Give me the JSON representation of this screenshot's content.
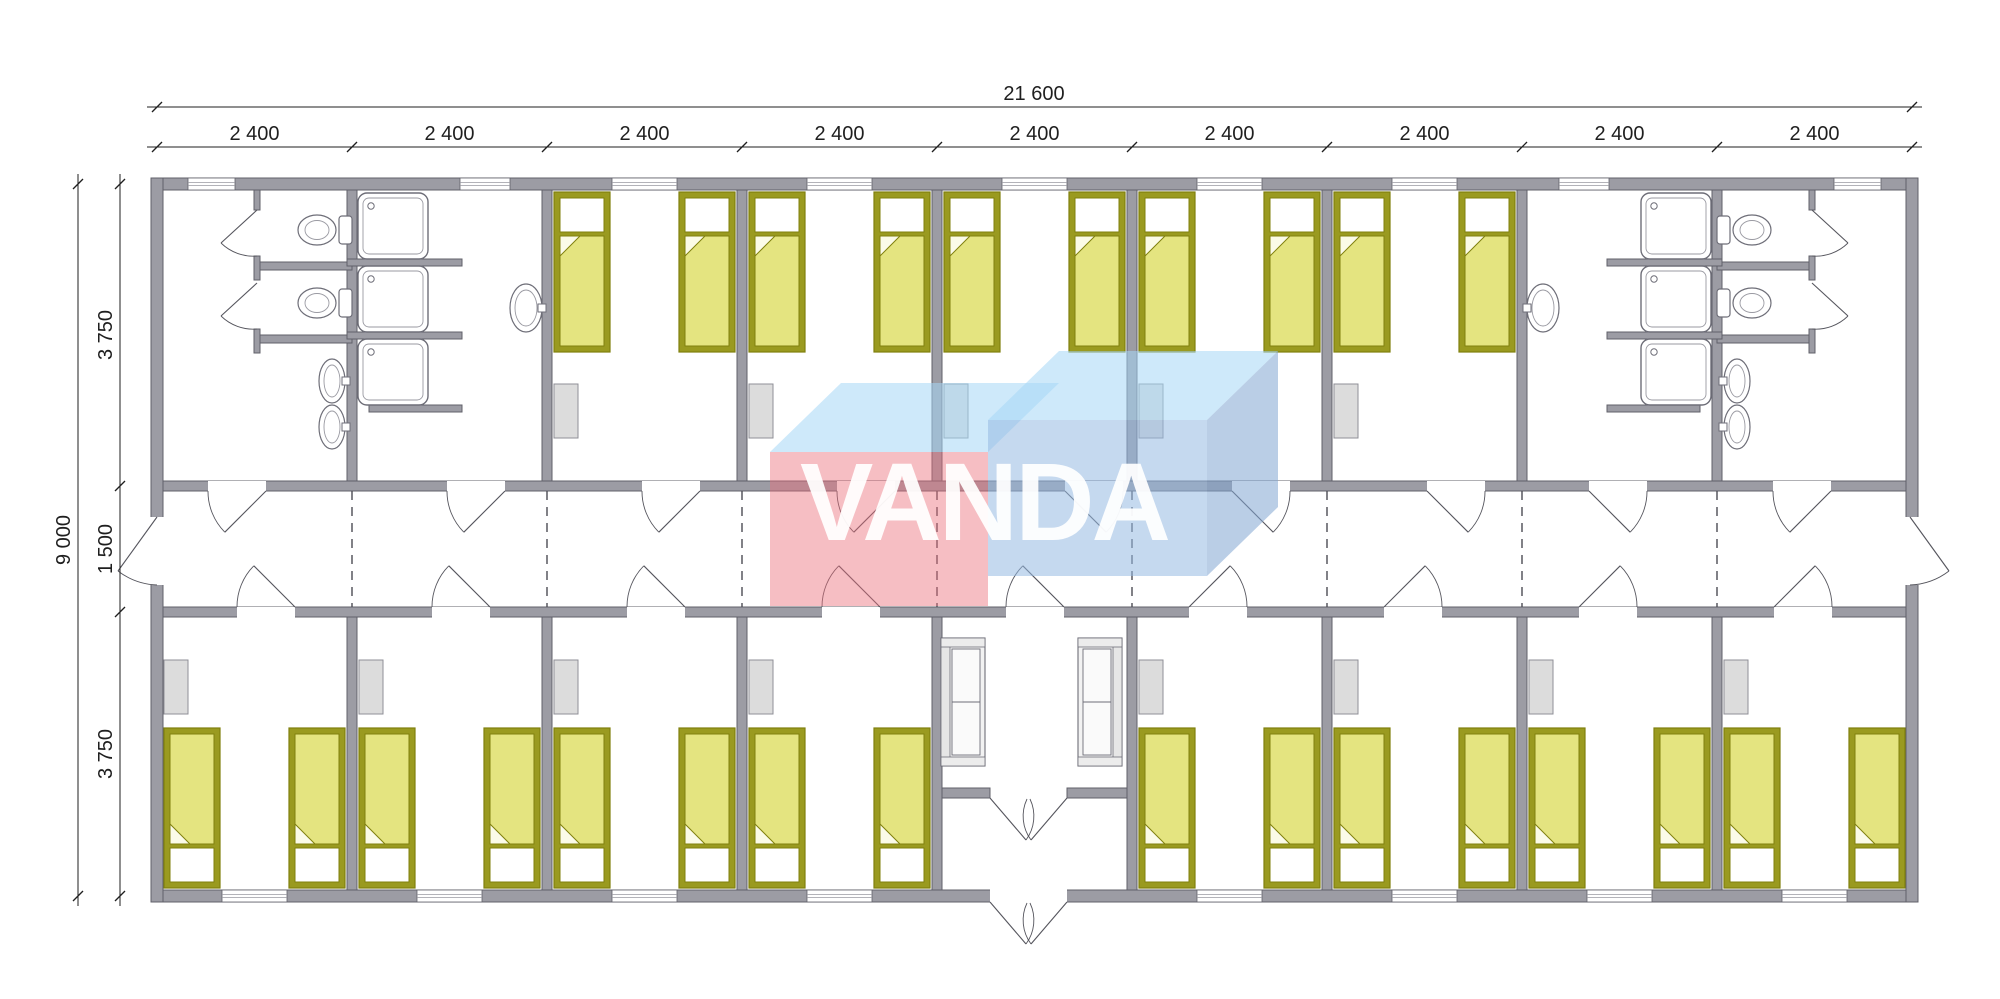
{
  "watermark": {
    "text": "VANDA"
  },
  "dimensions": {
    "overall_width": "21 600",
    "module_width": "2 400",
    "module_count": 9,
    "overall_depth": "9 000",
    "depth_segments": [
      "3 750",
      "1 500",
      "3 750"
    ]
  },
  "inventory": {
    "bedrooms": 13,
    "single_beds": 26,
    "wardrobes": 13,
    "shower_cabins": 6,
    "toilets": 4,
    "wash_basins": 6,
    "sofas": 2,
    "wc_rooms": 2,
    "shower_rooms": 2,
    "entrance_lobby": 1,
    "corridor": 1
  },
  "colors": {
    "wall_fill": "#9c9ca4",
    "wall_stroke": "#60606a",
    "bed_frame": "#9a9a20",
    "bed_blanket": "#e4e480",
    "bed_outline": "#80800e",
    "fold_fill": "#fbfbe8",
    "pillow": "#ffffff",
    "furniture_fill": "#dcdcdc",
    "furniture_stroke": "#8f8f97",
    "fixture_stroke": "#6e6e78",
    "fixture_fill": "#ffffff",
    "door_line": "#55555d",
    "dash_line": "#4c4c54",
    "dim_color": "#1f1f1f",
    "wm_red": "rgba(236,110,122,0.45)",
    "wm_red_top": "rgba(165,215,245,0.55)",
    "wm_blue": "rgba(150,185,225,0.55)",
    "wm_blue_top": "rgba(165,215,245,0.55)",
    "wm_blue_side": "rgba(130,165,210,0.55)",
    "wm_text": "rgba(255,255,255,0.93)"
  },
  "layout": {
    "canvas": {
      "w": 2000,
      "h": 999
    },
    "wall_x": [
      157,
      352,
      547,
      742,
      937,
      1132,
      1327,
      1522,
      1717,
      1912
    ],
    "y": {
      "top_out": 178,
      "top_in": 190,
      "corr_top_out": 481,
      "corr_top_in": 491,
      "corr_bot_in": 607,
      "corr_bot_out": 617,
      "bot_in": 890,
      "bot_out": 902,
      "left_out": 151,
      "left_in": 163,
      "right_in": 1906,
      "right_out": 1918
    },
    "top_bedrooms": [
      [
        547,
        742
      ],
      [
        742,
        937
      ],
      [
        937,
        1132
      ],
      [
        1132,
        1327
      ],
      [
        1327,
        1522
      ]
    ],
    "bottom_bedrooms": [
      [
        157,
        352
      ],
      [
        352,
        547
      ],
      [
        547,
        742
      ],
      [
        742,
        937
      ],
      [
        1132,
        1327
      ],
      [
        1327,
        1522
      ],
      [
        1522,
        1717
      ],
      [
        1717,
        1912
      ]
    ],
    "windows_top": [
      [
        188,
        235
      ],
      [
        460,
        510
      ],
      [
        612,
        677
      ],
      [
        807,
        872
      ],
      [
        1002,
        1067
      ],
      [
        1197,
        1262
      ],
      [
        1392,
        1457
      ],
      [
        1559,
        1609
      ],
      [
        1834,
        1881
      ]
    ],
    "windows_bottom": [
      [
        222,
        287
      ],
      [
        417,
        482
      ],
      [
        612,
        677
      ],
      [
        807,
        872
      ],
      [
        1197,
        1262
      ],
      [
        1392,
        1457
      ],
      [
        1587,
        1652
      ],
      [
        1782,
        1847
      ]
    ],
    "doors_top": [
      {
        "x1": 208,
        "x2": 266,
        "hinge": "right"
      },
      {
        "x1": 447,
        "x2": 505,
        "hinge": "right"
      },
      {
        "x1": 642,
        "x2": 700,
        "hinge": "right"
      },
      {
        "x1": 837,
        "x2": 895,
        "hinge": "right"
      },
      {
        "x1": 1065,
        "x2": 1123,
        "hinge": "left"
      },
      {
        "x1": 1232,
        "x2": 1290,
        "hinge": "left"
      },
      {
        "x1": 1427,
        "x2": 1485,
        "hinge": "left"
      },
      {
        "x1": 1589,
        "x2": 1647,
        "hinge": "left"
      },
      {
        "x1": 1773,
        "x2": 1831,
        "hinge": "right"
      }
    ],
    "doors_bottom": [
      {
        "x1": 237,
        "x2": 295,
        "hinge": "right"
      },
      {
        "x1": 432,
        "x2": 490,
        "hinge": "right"
      },
      {
        "x1": 627,
        "x2": 685,
        "hinge": "right"
      },
      {
        "x1": 822,
        "x2": 880,
        "hinge": "right"
      },
      {
        "x1": 1006,
        "x2": 1064,
        "hinge": "right"
      },
      {
        "x1": 1189,
        "x2": 1247,
        "hinge": "left"
      },
      {
        "x1": 1384,
        "x2": 1442,
        "hinge": "left"
      },
      {
        "x1": 1579,
        "x2": 1637,
        "hinge": "left"
      },
      {
        "x1": 1774,
        "x2": 1832,
        "hinge": "left"
      }
    ],
    "corridor_end_doors": {
      "y1": 517,
      "y2": 585
    },
    "vestibule": {
      "x1": 937,
      "x2": 1132,
      "door_wall_y": 788,
      "door_opening": [
        990,
        1067
      ]
    },
    "watermark": {
      "red_front": [
        770,
        452,
        218,
        154
      ],
      "red_top": "770,452 841,383 1059,383 988,452",
      "blue_front": [
        988,
        420,
        219,
        156
      ],
      "blue_top": "988,420 1059,351 1278,351 1207,420",
      "blue_side": "1207,420 1278,351 1278,507 1207,576",
      "text_x": 984,
      "text_y": 540,
      "font_size": 110
    }
  }
}
